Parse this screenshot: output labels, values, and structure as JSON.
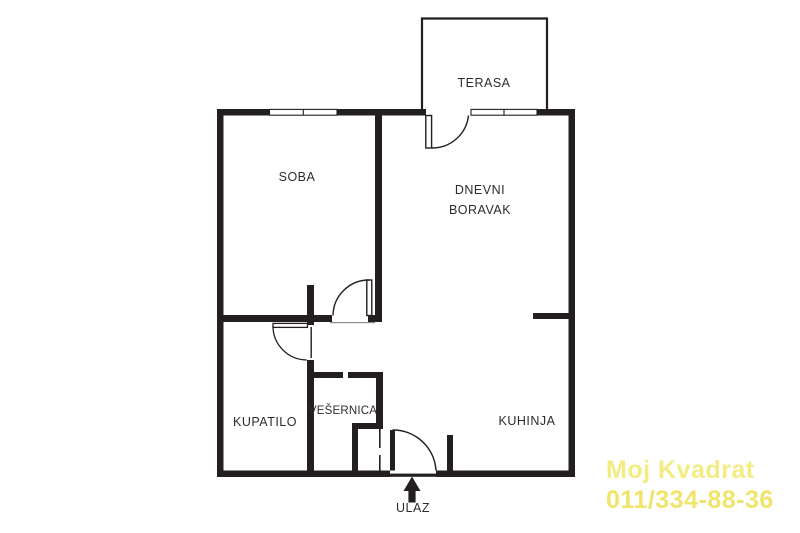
{
  "labels": {
    "terasa": "TERASA",
    "soba": "SOBA",
    "dnevni_boravak_line1": "DNEVNI",
    "dnevni_boravak_line2": "BORAVAK",
    "kupatilo": "KUPATILO",
    "vesernica": "VEŠERNICA",
    "kuhinja": "KUHINJA",
    "ulaz": "ULAZ"
  },
  "watermark": {
    "line1": "Moj Kvadrat",
    "line2": "011/334-88-36",
    "color_line1": "#F2EC83",
    "color_line2": "#F0E56A"
  },
  "colors": {
    "walls": "#231F20",
    "background": "#FFFFFF",
    "label_text": "#2E2C2B"
  }
}
